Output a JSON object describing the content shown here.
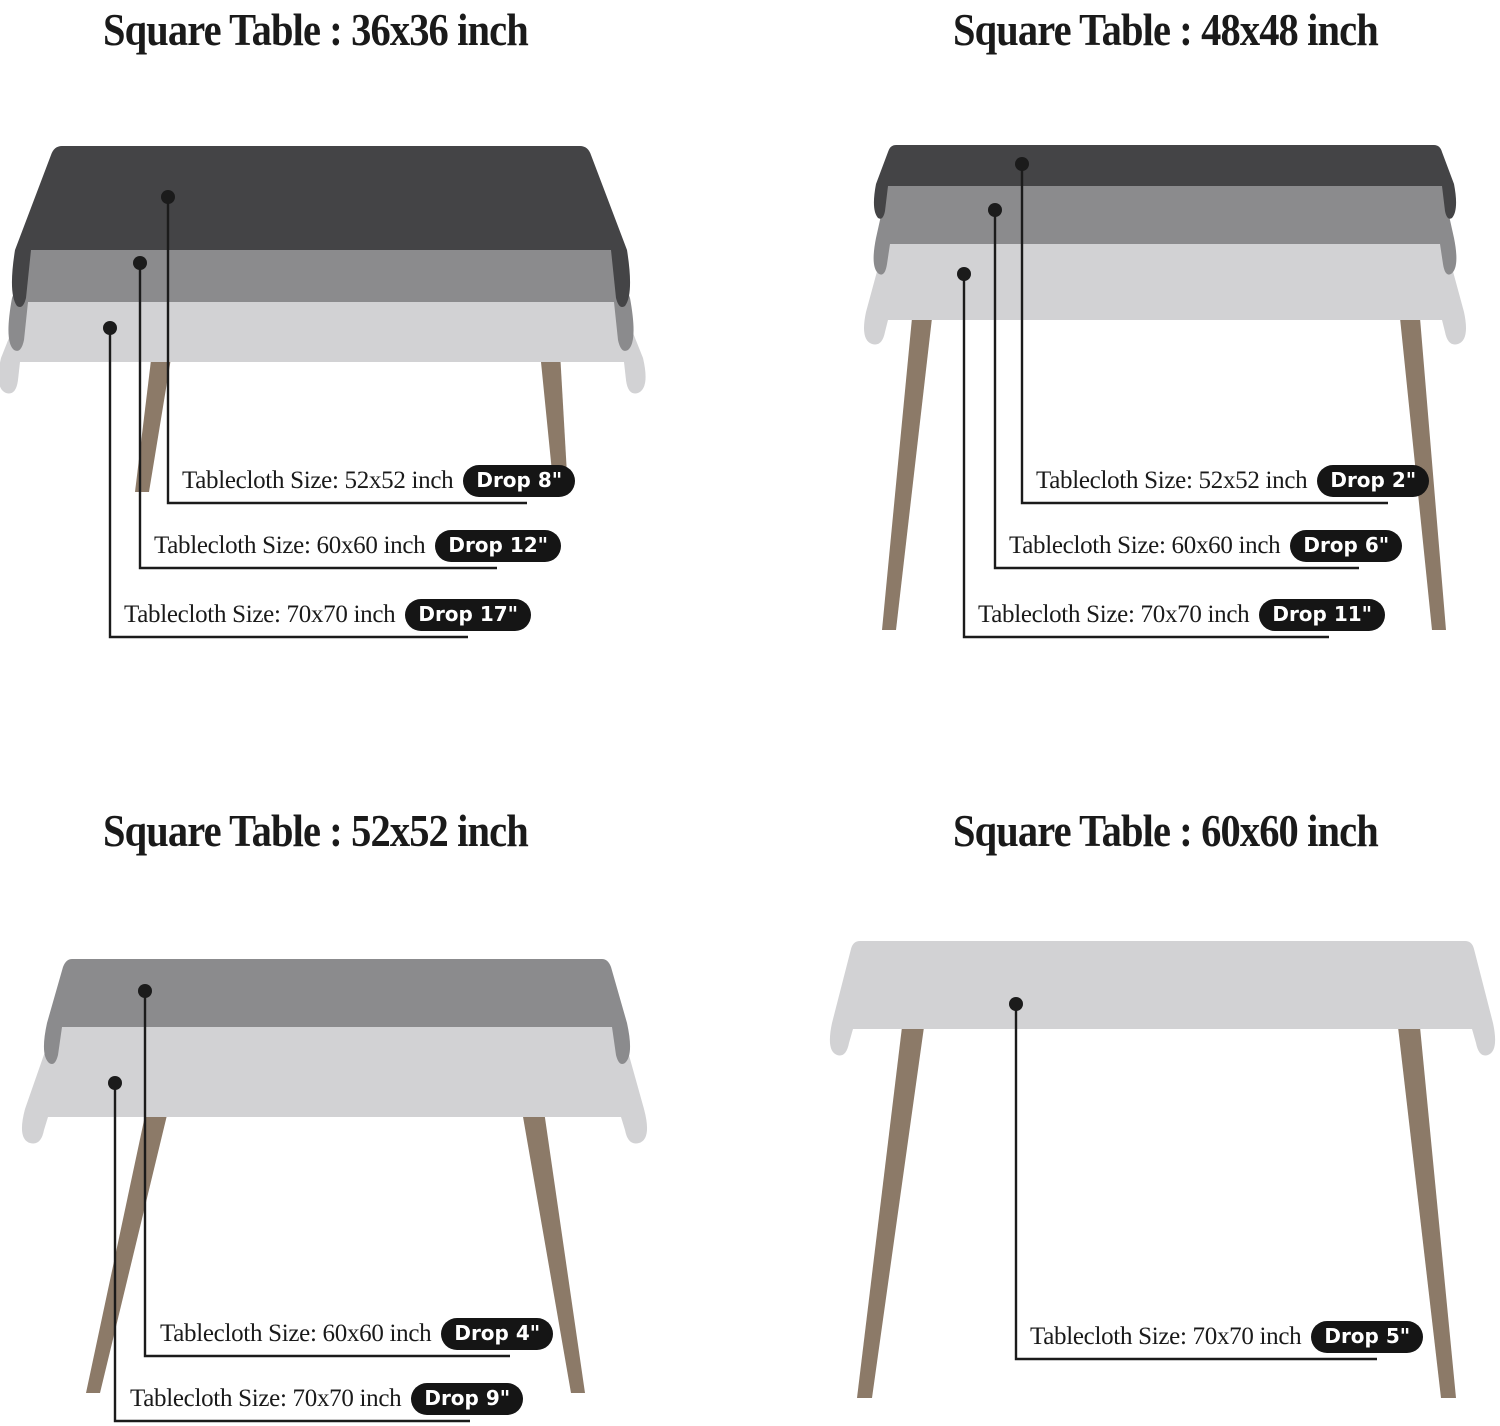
{
  "colors": {
    "background": "#ffffff",
    "text": "#1a1a1a",
    "line": "#1b1b1b",
    "cloth_dark": "#444446",
    "cloth_medium": "#8b8b8d",
    "cloth_light": "#d2d2d4",
    "leg": "#8c7a68",
    "pill_bg": "#151515",
    "pill_text": "#ffffff"
  },
  "quadrants": [
    {
      "title": "Square Table : 36x36 inch",
      "labels": [
        {
          "text": "Tablecloth Size: 52x52 inch",
          "drop": "Drop 8\""
        },
        {
          "text": "Tablecloth Size: 60x60 inch",
          "drop": "Drop 12\""
        },
        {
          "text": "Tablecloth Size: 70x70 inch",
          "drop": "Drop 17\""
        }
      ]
    },
    {
      "title": "Square Table : 48x48 inch",
      "labels": [
        {
          "text": "Tablecloth Size: 52x52 inch",
          "drop": "Drop 2\""
        },
        {
          "text": "Tablecloth Size: 60x60 inch",
          "drop": "Drop 6\""
        },
        {
          "text": "Tablecloth Size: 70x70 inch",
          "drop": "Drop 11\""
        }
      ]
    },
    {
      "title": "Square Table : 52x52 inch",
      "labels": [
        {
          "text": "Tablecloth Size: 60x60 inch",
          "drop": "Drop 4\""
        },
        {
          "text": "Tablecloth Size: 70x70 inch",
          "drop": "Drop 9\""
        }
      ]
    },
    {
      "title": "Square Table : 60x60 inch",
      "labels": [
        {
          "text": "Tablecloth Size: 70x70 inch",
          "drop": "Drop 5\""
        }
      ]
    }
  ]
}
